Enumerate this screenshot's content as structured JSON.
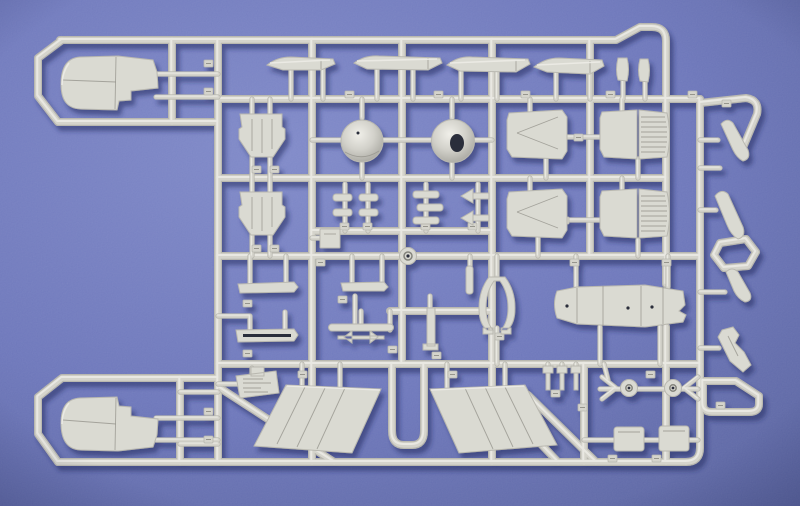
{
  "scene": {
    "description": "Photograph of a light grey injection-moulded model aircraft kit sprue (parts tree) lying on a blue-violet textured background. The sprue contains two engine nacelle halves on the left, four tailplane blades along the top, two conical radomes, four rectangular intake panels, two large trapezoidal wing halves at the bottom centre, a long fuselage spine piece, wheels, blocks, pylons and many small parts, each attached to the runner frame with small numbered tags.",
    "colors": {
      "bg_center": "#7d87c7",
      "bg_mid": "#6a74b9",
      "bg_edge": "#555f9b",
      "runner_base": "#d5d4cc",
      "runner_mid": "#b9b8b0",
      "runner_light": "#ecebe5",
      "part": "#dadad2",
      "part_line": "#96958d",
      "part_deep": "#83837b",
      "hole_dark": "#2c2f3a",
      "shadow": "#232a5e"
    }
  },
  "sprue": {
    "runners": [
      {
        "name": "frame-top-and-right-inner",
        "d": "M60,40 H616 L640,27 H652 Q666,27 666,41 V284 M666,327 V462"
      },
      {
        "name": "loop-top-left",
        "d": "M62,40 L38,58 V96 L58,122 H218"
      },
      {
        "name": "inner-vertical-top-left",
        "d": "M172,40 V122"
      },
      {
        "name": "vertical-1",
        "d": "M218,40 V462"
      },
      {
        "name": "vertical-2",
        "d": "M312,40 V462"
      },
      {
        "name": "vertical-3",
        "d": "M402,40 V364"
      },
      {
        "name": "vertical-4",
        "d": "M492,40 V462"
      },
      {
        "name": "vertical-5",
        "d": "M590,40 V256 M584,364 V462"
      },
      {
        "name": "frame-right-edge",
        "d": "M700,99 V448 Q700,462 686,462"
      },
      {
        "name": "horizontal-2",
        "d": "M218,99 H700"
      },
      {
        "name": "horizontal-3",
        "d": "M218,178 H666"
      },
      {
        "name": "horizontal-3b",
        "d": "M312,231 H492"
      },
      {
        "name": "horizontal-center",
        "d": "M218,256 H700"
      },
      {
        "name": "horizontal-3c",
        "d": "M390,311 H492"
      },
      {
        "name": "horizontal-5",
        "d": "M218,364 H700"
      },
      {
        "name": "horizontal-bottom",
        "d": "M58,462 H686"
      },
      {
        "name": "loop-bottom-left",
        "d": "M62,378 H218 M62,378 L38,397 V434 L58,462"
      },
      {
        "name": "inner-vertical-bottom-left",
        "d": "M180,378 V462"
      },
      {
        "name": "wing-u-runner",
        "d": "M392,364 V431 Q392,445 404,445 H412 Q424,445 424,431 V364"
      },
      {
        "name": "diagonal-left",
        "d": "M220,388 L334,462"
      },
      {
        "name": "diagonal-right-1",
        "d": "M528,395 L596,462"
      },
      {
        "name": "diagonal-right-2",
        "d": "M518,420 L558,462"
      },
      {
        "name": "outer-arm-top-right",
        "d": "M700,103 L746,98 Q760,100 757,114 L742,150"
      },
      {
        "name": "outer-hexagon-loop",
        "d": "M720,243 L746,239 L756,252 L748,266 L724,268 L714,255 Z"
      },
      {
        "name": "outer-boot-loop",
        "d": "M703,381 H736 L759,396 V404 Q759,412 749,412 H712 Q703,412 703,404 Z"
      }
    ],
    "stems": [
      {
        "name": "gates-nacelle-top",
        "d": "M156,74 H218 M156,97 H218"
      },
      {
        "name": "gates-nacelle-bottom",
        "d": "M156,418 H218 M156,440 H218 M180,392 H218 M180,444 H218"
      },
      {
        "name": "gates-stabilizers",
        "d": "M291,68 V99 M323,64 V99 M377,66 V99 M413,66 V99 M461,69 V99 M497,70 V99 M556,70 V99 M590,72 V99"
      },
      {
        "name": "gates-small-blades",
        "d": "M623,79 V99 M645,80 V99"
      },
      {
        "name": "gates-domes",
        "d": "M362,99 V118 M362,163 V178 M452,99 V118 M452,163 V178 M312,140 H341 M383,140 H431 M474,140 H492"
      },
      {
        "name": "gates-panels",
        "d": "M530,99 V113 M546,159 V178 M530,178 V192 M538,238 V256 M622,99 V112 M638,159 V178 M622,178 V191 M638,240 V256 M567,137 H601 M567,220 H601"
      },
      {
        "name": "gates-intake-ramps",
        "d": "M252,99 V114 M270,99 V114 M252,157 V178 M270,157 V178 M252,178 V193 M270,178 V193 M252,235 V256 M270,235 V256"
      },
      {
        "name": "gates-small-clusters",
        "d": "M345,184 V231 M368,184 V231 M426,184 V231 M478,184 V231 M312,238 H321"
      },
      {
        "name": "gates-slats",
        "d": "M250,256 V284 M286,256 V284 M352,256 V284 M382,256 V284 M218,316 H250 M250,316 V331 M285,312 V331 M355,296 V326 M390,311 V330 M361,311 V326"
      },
      {
        "name": "gates-spine",
        "d": "M576,256 V287 M668,256 V287 M600,327 V364 M660,327 V364"
      },
      {
        "name": "gates-fork",
        "d": "M497,256 V276 M497,328 V364"
      },
      {
        "name": "gates-wings",
        "d": "M302,364 V386 M340,364 V388 M447,364 V388 M505,364 V386"
      },
      {
        "name": "gates-pins",
        "d": "M548,364 V372 M562,364 V372 M576,364 V372"
      },
      {
        "name": "wheel-axle-twig",
        "d": "M600,389 H698 M604,364 L608,380"
      },
      {
        "name": "wheel-fork-left",
        "d": "M602,377 L616,388 L602,399"
      },
      {
        "name": "wheel-fork-right",
        "d": "M698,377 L684,388 L698,399"
      },
      {
        "name": "block-twig",
        "d": "M584,440 H698"
      },
      {
        "name": "outer-stubs",
        "d": "M700,140 H718 M700,168 H720 M700,210 H716 M700,292 H725 M700,348 H719"
      },
      {
        "name": "gates-text-plate",
        "d": "M218,384 H242 M252,368 V376"
      },
      {
        "name": "gates-rods",
        "d": "M430,296 V310 M470,256 V266"
      }
    ],
    "tags": [
      [
        204,
        60
      ],
      [
        204,
        88
      ],
      [
        345,
        91
      ],
      [
        434,
        91
      ],
      [
        521,
        91
      ],
      [
        606,
        91
      ],
      [
        688,
        91
      ],
      [
        252,
        166
      ],
      [
        270,
        166
      ],
      [
        340,
        223
      ],
      [
        363,
        223
      ],
      [
        421,
        223
      ],
      [
        468,
        223
      ],
      [
        316,
        259
      ],
      [
        252,
        245
      ],
      [
        270,
        245
      ],
      [
        558,
        134
      ],
      [
        574,
        134
      ],
      [
        560,
        217
      ],
      [
        243,
        300
      ],
      [
        338,
        296
      ],
      [
        243,
        350
      ],
      [
        388,
        346
      ],
      [
        298,
        371
      ],
      [
        448,
        371
      ],
      [
        646,
        371
      ],
      [
        204,
        408
      ],
      [
        204,
        436
      ],
      [
        578,
        404
      ],
      [
        608,
        455
      ],
      [
        652,
        455
      ],
      [
        716,
        402
      ],
      [
        722,
        100
      ],
      [
        570,
        259
      ],
      [
        662,
        259
      ],
      [
        432,
        352
      ],
      [
        551,
        390
      ],
      [
        495,
        333
      ]
    ],
    "parts": [
      {
        "name": "engine-nacelle-top-left",
        "d": "M80,57 C66,58 61,69 61,84 C61,99 66,108 80,109 L117,110 L119,101 L131,100 L131,91 L158,88 L157,72 L153,60 L118,56 Z",
        "lines": [
          "M116,57 L115,109",
          "M63,80 L116,82"
        ],
        "light": [
          "M69,63 Q62,73 62,85"
        ]
      },
      {
        "name": "engine-nacelle-bottom-left",
        "d": "M80,450 C66,449 61,438 61,423 C61,408 66,399 80,398 L117,397 L119,406 L131,407 L131,416 L158,419 L157,435 L153,447 L118,451 Z",
        "lines": [
          "M116,398 L115,450",
          "M63,420 L116,424"
        ],
        "light": [
          "M69,403 Q62,412 62,424"
        ]
      },
      {
        "name": "tailplane-1",
        "d": "M267,65 Q277,57 291,57 L333,59 L335,64 L321,70 L283,70 Z",
        "lines": [
          "M321,60 L321,69"
        ],
        "light": [
          "M270,63 L330,60"
        ]
      },
      {
        "name": "tailplane-2",
        "d": "M354,63 Q365,55 379,56 L440,58 L442,63 L428,70 L367,69 Z",
        "lines": [
          "M428,58 L428,69"
        ],
        "light": [
          "M357,61 L437,59"
        ]
      },
      {
        "name": "tailplane-3",
        "d": "M447,65 Q458,56 472,57 L528,59 L530,64 L516,72 L460,71 Z",
        "lines": [
          "M516,60 L516,71"
        ],
        "light": [
          "M450,63 L525,60"
        ]
      },
      {
        "name": "tailplane-4",
        "d": "M534,67 Q545,58 559,58 L602,60 L604,66 L590,74 L547,72 Z",
        "lines": [
          "M590,61 L590,73"
        ],
        "light": [
          "M537,65 L600,62"
        ]
      },
      {
        "name": "small-fin-blade-1",
        "d": "M618,58 Q615,70 618,80 L627,81 Q630,69 627,58 Z"
      },
      {
        "name": "small-fin-blade-2",
        "d": "M640,59 Q637,70 640,81 L648,82 Q651,70 648,59 Z"
      },
      {
        "name": "radome-cone-left",
        "circle": [
          362,
          141,
          21
        ],
        "fill": "dome",
        "lines": [
          "M345,152 Q362,162 379,151"
        ],
        "dots": [
          [
            358,
            133,
            1.5
          ]
        ]
      },
      {
        "name": "radome-cone-right",
        "circle": [
          453,
          141,
          21.5
        ],
        "fill": "dome",
        "holes": [
          "M450,143 a7,9 0 1 0 14,0 a7,9 0 1 0 -14,0"
        ]
      },
      {
        "name": "intake-ramp-top",
        "d": "M240,114 L282,114 L282,127 L285,129 L285,139 L273,157 L251,157 L239,139 L239,129 L242,127 Z",
        "lines": [
          "M252,119 V151",
          "M262,119 V153",
          "M272,119 V149"
        ]
      },
      {
        "name": "intake-ramp-bottom",
        "d": "M240,192 L282,192 L282,205 L285,207 L285,217 L273,235 L251,235 L239,217 L239,207 L242,205 Z",
        "lines": [
          "M252,197 V229",
          "M262,197 V231",
          "M272,197 V227"
        ]
      },
      {
        "name": "panel-chevron-top",
        "d": "M509,113 L562,110 L567,117 L567,151 L562,159 L512,157 L507,149 L507,120 Z",
        "lines": [
          "M558,117 L517,133",
          "M517,133 L558,149"
        ]
      },
      {
        "name": "panel-chevron-bottom",
        "d": "M509,192 L562,189 L567,196 L567,230 L562,238 L512,236 L507,228 L507,199 Z",
        "lines": [
          "M558,196 L517,212",
          "M517,212 L558,228"
        ]
      },
      {
        "name": "panel-ribbed-top",
        "d": "M602,112 L637,110 L637,159 L604,157 L600,149 L600,118 Z M639,110 L667,113 Q672,135 667,157 L639,159 Z",
        "lines": [
          "M641,117 h24",
          "M641,122 h25",
          "M641,127 h26",
          "M641,132 h26",
          "M641,137 h26",
          "M641,142 h26",
          "M641,147 h25",
          "M641,152 h24"
        ]
      },
      {
        "name": "panel-ribbed-bottom",
        "d": "M602,191 L637,189 L637,238 L604,236 L600,228 L600,197 Z M639,189 L667,192 Q672,214 667,236 L639,238 Z",
        "lines": [
          "M641,196 h24",
          "M641,201 h25",
          "M641,206 h26",
          "M641,211 h26",
          "M641,216 h26",
          "M641,221 h26",
          "M641,226 h25",
          "M641,231 h24"
        ]
      },
      {
        "name": "small-cylinder-1",
        "rect": [
          333,
          194,
          19,
          7,
          3
        ]
      },
      {
        "name": "small-cylinder-2",
        "rect": [
          359,
          194,
          19,
          7,
          3
        ]
      },
      {
        "name": "small-cylinder-3",
        "rect": [
          333,
          209,
          19,
          7,
          3
        ]
      },
      {
        "name": "small-cylinder-4",
        "rect": [
          359,
          209,
          19,
          7,
          3
        ]
      },
      {
        "name": "small-cylinder-5",
        "rect": [
          413,
          191,
          26,
          7,
          3
        ]
      },
      {
        "name": "small-cylinder-6",
        "rect": [
          417,
          204,
          26,
          7,
          3
        ]
      },
      {
        "name": "small-cylinder-7",
        "rect": [
          413,
          217,
          26,
          7,
          3
        ]
      },
      {
        "name": "arrow-clip-1",
        "d": "M461,196 L473,189 L473,203 Z M473,193 h16 v6 h-16 Z"
      },
      {
        "name": "arrow-clip-2",
        "d": "M461,218 L473,211 L473,225 Z M473,215 h16 v6 h-16 Z"
      },
      {
        "name": "square-plate-small",
        "rect": [
          320,
          229,
          20,
          19,
          1
        ],
        "lines": [
          "M324,234 h12"
        ]
      },
      {
        "name": "sprue-center-boss",
        "circle": [
          408,
          256,
          8.5
        ],
        "rings": [
          [
            408,
            256,
            4
          ]
        ],
        "dots": [
          [
            408,
            256,
            1.6
          ]
        ]
      },
      {
        "name": "slat-1",
        "d": "M238,284 L294,282 L298,287 L294,292 L240,293 Z"
      },
      {
        "name": "slat-2",
        "d": "M341,283 L384,282 L388,287 L384,291 L343,291 Z"
      },
      {
        "name": "slat-grooved",
        "d": "M236,330 L294,329 L298,335 L294,341 L238,342 Z",
        "holes": [
          "M243,334 h48 v3 h-48 Z"
        ]
      },
      {
        "name": "bar-and-arrows-assembly",
        "d": "M332,324 h58 a3.5,3.5 0 0 1 0,7 h-58 a3.5,3.5 0 0 1 0,-7 Z M338,336 h46 v3 h-46 Z M352,331 l-8,6 l8,6 Z M370,331 l8,6 l-8,6 Z"
      },
      {
        "name": "rod-part",
        "d": "M427,308 h8 v38 h-8 Z M423,344 h15 v6 h-15 Z"
      },
      {
        "name": "rod-small",
        "rect": [
          466,
          266,
          7,
          28,
          3
        ]
      },
      {
        "name": "wing-half-left",
        "d": "M286,385 L381,389 L352,453 L254,446 Z",
        "lines": [
          "M305,387 L277,444",
          "M325,388 L297,447",
          "M345,388 L317,449"
        ],
        "light": [
          "M287,386 L380,390"
        ]
      },
      {
        "name": "wing-half-right",
        "d": "M430,389 L525,385 L557,445 L459,453 Z",
        "lines": [
          "M505,387 L533,444",
          "M485,387 L513,447",
          "M465,388 L493,449"
        ],
        "light": [
          "M431,390 L524,386"
        ]
      },
      {
        "name": "fuselage-spine",
        "d": "M557,291 Q552,304 557,318 L577,324 L645,327 L683,322 L686,315 L679,311 L685,305 L683,291 L645,285 L577,287 Z",
        "lines": [
          "M577,288 V323",
          "M603,286 V326",
          "M641,286 V326",
          "M663,286 V324"
        ],
        "dots": [
          [
            567,
            306,
            1.6
          ],
          [
            628,
            308,
            1.6
          ],
          [
            652,
            307,
            1.6
          ]
        ]
      },
      {
        "name": "horseshoe-fork",
        "d": "M489,277 Q479,290 479,308 Q479,324 487,330 L493,330 Q486,322 486,308 Q486,292 494,281 L500,281 Q508,292 508,308 Q508,322 501,330 L507,330 Q515,324 515,308 Q515,290 505,277 Z M483,328 h10 v6 h-10 Z M501,328 h10 v6 h-10 Z"
      },
      {
        "name": "pin-1",
        "d": "M543,366 h10 v7 h-10 Z M546,373 h4 v17 h-4 Z"
      },
      {
        "name": "pin-2",
        "d": "M557,366 h10 v7 h-10 Z M560,373 h4 v17 h-4 Z"
      },
      {
        "name": "pin-3",
        "d": "M571,366 h10 v7 h-10 Z M574,373 h4 v17 h-4 Z"
      },
      {
        "name": "wheel-left",
        "circle": [
          629,
          388,
          8.5
        ],
        "rings": [
          [
            629,
            388,
            3.2
          ]
        ],
        "dots": [
          [
            629,
            388,
            1.4
          ]
        ]
      },
      {
        "name": "wheel-right",
        "circle": [
          673,
          388,
          8.5
        ],
        "rings": [
          [
            673,
            388,
            3.2
          ]
        ],
        "dots": [
          [
            673,
            388,
            1.4
          ]
        ]
      },
      {
        "name": "block-left",
        "rect": [
          614,
          427,
          30,
          24,
          3
        ],
        "lines": [
          "M618,432 h22"
        ]
      },
      {
        "name": "block-right",
        "rect": [
          659,
          426,
          30,
          25,
          3
        ],
        "lines": [
          "M663,431 h22"
        ]
      },
      {
        "name": "outer-blade-1",
        "d": "M721,124 Q727,117 733,123 L748,150 Q751,159 743,161 Q737,158 733,150 Z"
      },
      {
        "name": "outer-blade-2",
        "d": "M715,196 Q721,188 728,194 L743,227 Q746,237 738,239 Q731,235 727,225 Z"
      },
      {
        "name": "outer-blade-3",
        "d": "M726,272 Q732,266 738,272 L750,293 Q753,301 745,302 Q738,299 734,291 Z"
      },
      {
        "name": "outer-pylon",
        "d": "M722,330 L733,327 L739,335 L735,343 L744,352 L751,365 L743,372 L730,361 L724,349 L718,337 Z",
        "lines": [
          "M728,336 L738,356"
        ]
      },
      {
        "name": "molded-text-plate",
        "d": "M236,376 L276,371 L279,393 L240,398 Z M251,367 h13 v9 h-13 Z",
        "lines": [
          "M243,379 h20",
          "M243,383 h28",
          "M243,388 h18",
          "M244,392 h24"
        ]
      }
    ]
  }
}
